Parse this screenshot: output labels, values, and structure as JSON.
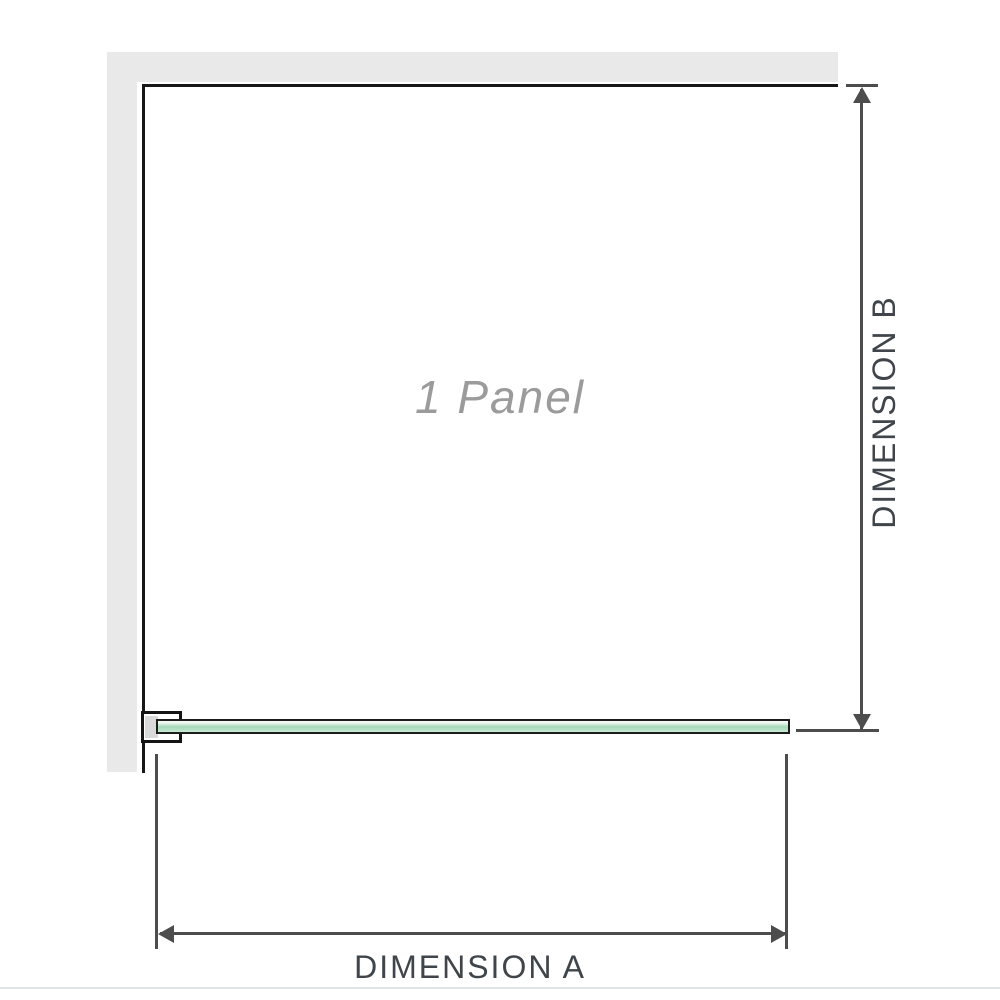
{
  "diagram": {
    "panel_label": "1 Panel",
    "dimension_a": {
      "label": "DIMENSION A"
    },
    "dimension_b": {
      "label": "DIMENSION B"
    }
  },
  "icons": {
    "arrow_up": "filled triangle pointing up",
    "arrow_down": "filled triangle pointing down",
    "arrow_left": "filled triangle pointing left",
    "arrow_right": "filled triangle pointing right"
  },
  "colors": {
    "background": "#ffffff",
    "wall_fill": "#e9e9e9",
    "outline_black": "#171717",
    "dimension_gray": "#4d4d4d",
    "dimension_label_text": "#3f454a",
    "panel_label_text": "#9b9b9b",
    "glass_green_mid": "#a6d9ba",
    "glass_green_light": "#cdebd8",
    "clamp_inner_gray": "#d9d9d9",
    "bottom_rule": "#e1e5e7"
  }
}
